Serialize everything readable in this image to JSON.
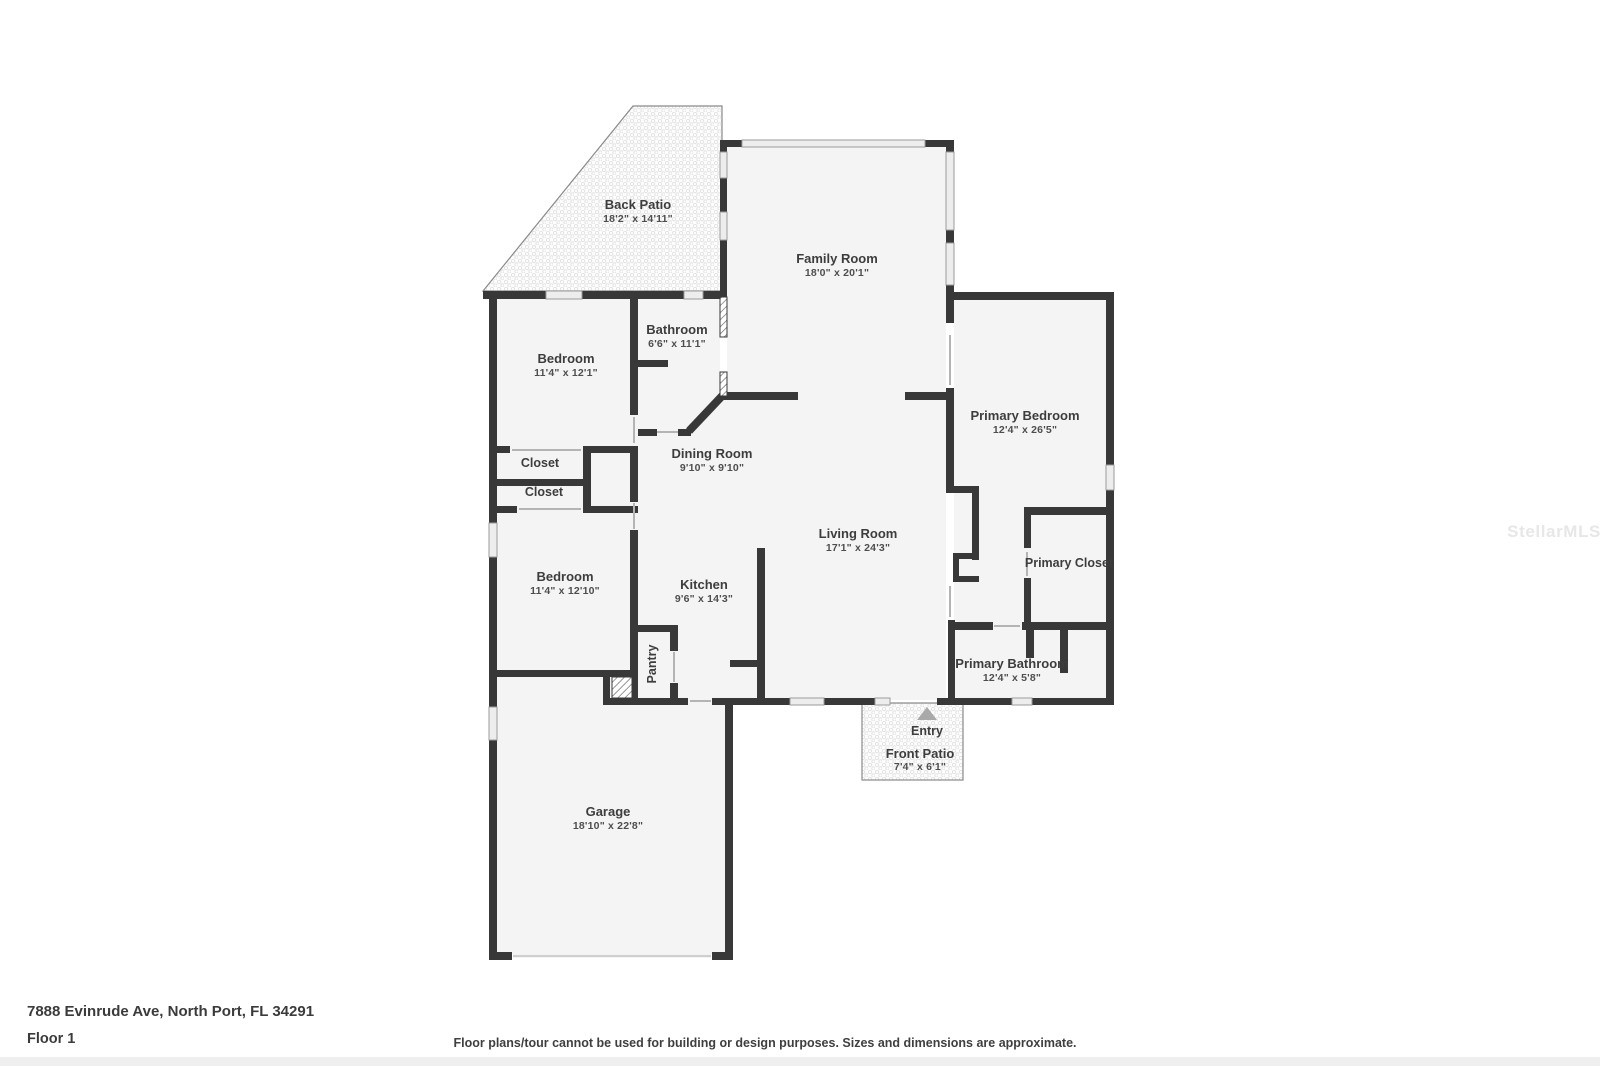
{
  "page": {
    "background": "#ffffff"
  },
  "watermark": {
    "text": "StellarMLS"
  },
  "footer": {
    "address": "7888 Evinrude Ave, North Port, FL 34291",
    "floor_label": "Floor 1",
    "disclaimer": "Floor plans/tour cannot be used for building or design purposes. Sizes and dimensions are approximate."
  },
  "colors": {
    "wall": "#383838",
    "room_fill": "#f4f4f4",
    "window_fill": "#ededed",
    "window_stroke": "#9b9b9b",
    "door_line": "#b4b4b4",
    "patio_border": "#8a8a8a",
    "label": "#3d3d3d",
    "dims": "#4e4e4e",
    "entry_arrow": "#a9a9a9"
  },
  "rooms": {
    "back_patio": {
      "name": "Back Patio",
      "dims": "18'2\" x 14'11\""
    },
    "family_room": {
      "name": "Family Room",
      "dims": "18'0\" x 20'1\""
    },
    "bathroom": {
      "name": "Bathroom",
      "dims": "6'6\" x 11'1\""
    },
    "bedroom_top": {
      "name": "Bedroom",
      "dims": "11'4\" x 12'1\""
    },
    "primary_bedroom": {
      "name": "Primary Bedroom",
      "dims": "12'4\" x 26'5\""
    },
    "closet_upper": {
      "name": "Closet"
    },
    "closet_lower": {
      "name": "Closet"
    },
    "dining_room": {
      "name": "Dining Room",
      "dims": "9'10\" x 9'10\""
    },
    "living_room": {
      "name": "Living Room",
      "dims": "17'1\" x 24'3\""
    },
    "primary_closet": {
      "name": "Primary Closet"
    },
    "bedroom_bottom": {
      "name": "Bedroom",
      "dims": "11'4\" x 12'10\""
    },
    "kitchen": {
      "name": "Kitchen",
      "dims": "9'6\" x 14'3\""
    },
    "pantry": {
      "name": "Pantry"
    },
    "primary_bathroom": {
      "name": "Primary Bathroom",
      "dims": "12'4\" x 5'8\""
    },
    "entry": {
      "name": "Entry"
    },
    "front_patio": {
      "name": "Front Patio",
      "dims": "7'4\" x 6'1\""
    },
    "garage": {
      "name": "Garage",
      "dims": "18'10\" x 22'8\""
    }
  }
}
